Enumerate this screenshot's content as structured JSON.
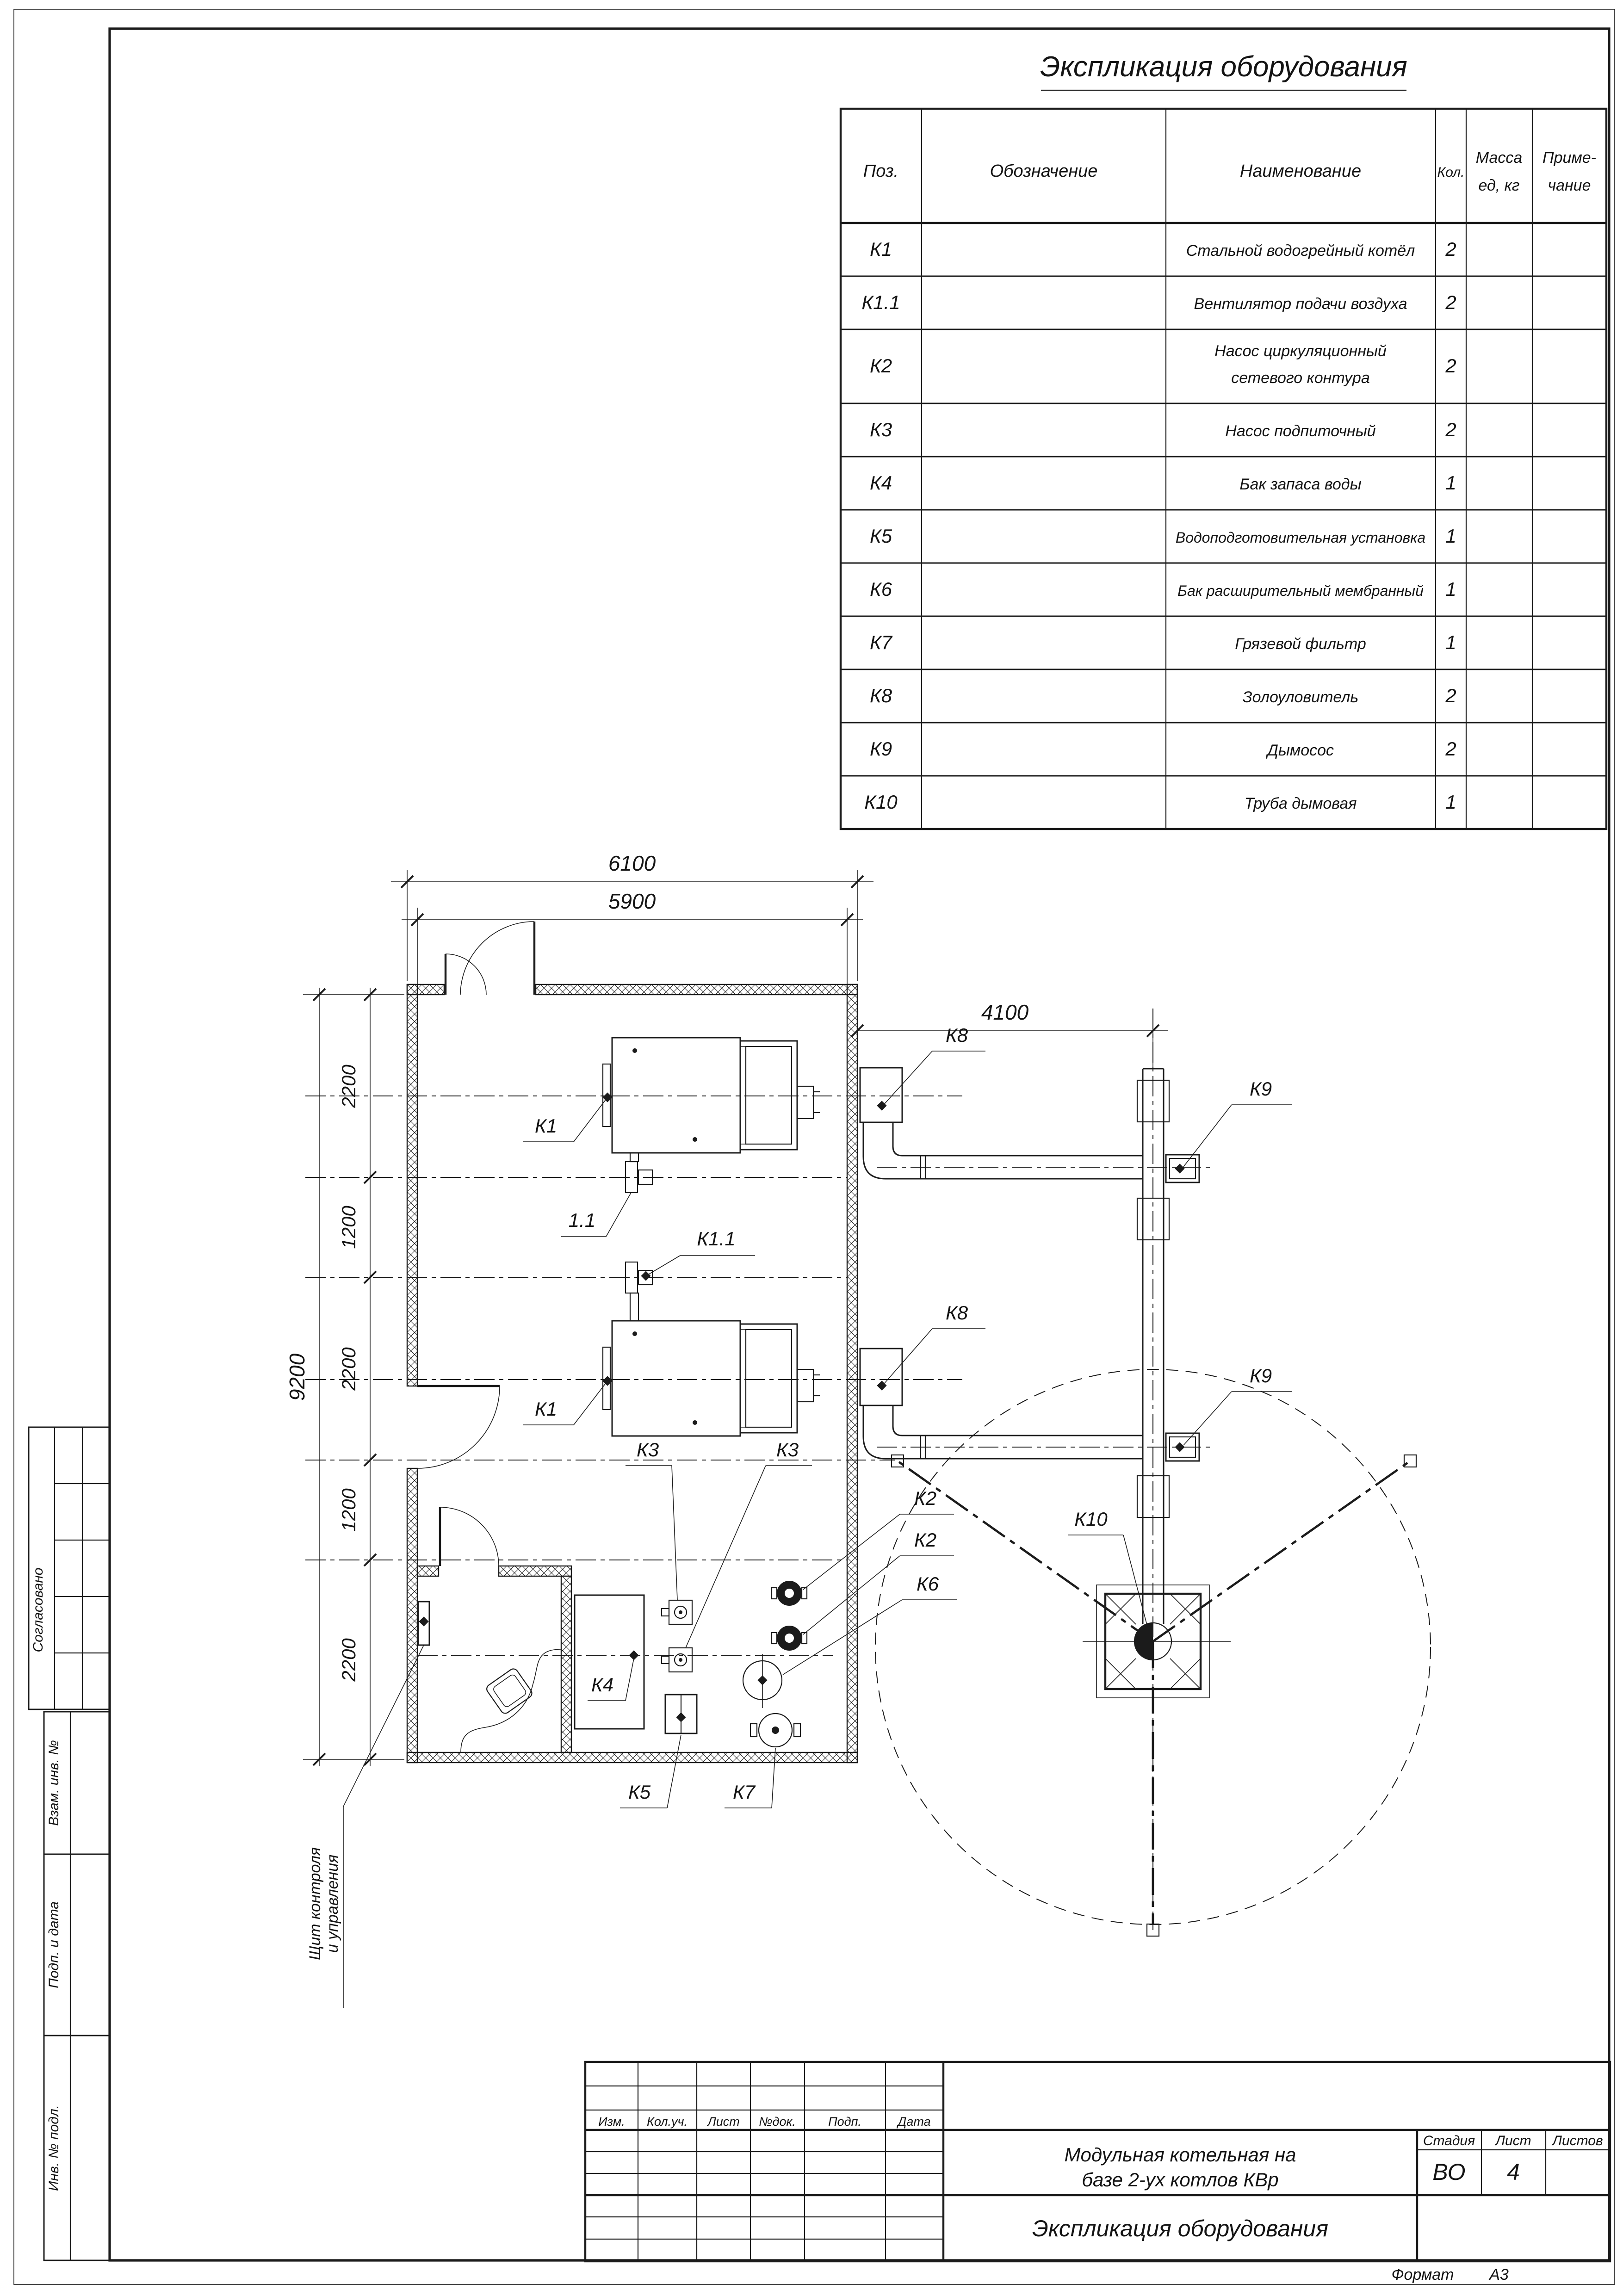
{
  "sheet": {
    "format_label": "Формат",
    "format_value": "А3"
  },
  "table": {
    "title": "Экспликация оборудования",
    "headers": {
      "pos": "Поз.",
      "designation": "Обозначение",
      "name": "Наименование",
      "qty": "Кол.",
      "mass_l1": "Масса",
      "mass_l2": "ед, кг",
      "note_l1": "Приме-",
      "note_l2": "чание"
    },
    "rows": [
      {
        "pos": "К1",
        "name": "Стальной водогрейный котёл",
        "qty": "2"
      },
      {
        "pos": "К1.1",
        "name": "Вентилятор подачи воздуха",
        "qty": "2"
      },
      {
        "pos": "К2",
        "name_l1": "Насос циркуляционный",
        "name_l2": "сетевого контура",
        "qty": "2"
      },
      {
        "pos": "К3",
        "name": "Насос подпиточный",
        "qty": "2"
      },
      {
        "pos": "К4",
        "name": "Бак запаса воды",
        "qty": "1"
      },
      {
        "pos": "К5",
        "name": "Водоподготовительная установка",
        "qty": "1"
      },
      {
        "pos": "К6",
        "name": "Бак расширительный мембранный",
        "qty": "1"
      },
      {
        "pos": "К7",
        "name": "Грязевой фильтр",
        "qty": "1"
      },
      {
        "pos": "К8",
        "name": "Золоуловитель",
        "qty": "2"
      },
      {
        "pos": "К9",
        "name": "Дымосос",
        "qty": "2"
      },
      {
        "pos": "К10",
        "name": "Труба дымовая",
        "qty": "1"
      }
    ]
  },
  "plan": {
    "dims": {
      "w6100": "6100",
      "w5900": "5900",
      "w4100": "4100",
      "h9200": "9200",
      "seg1": "2200",
      "seg2": "1200",
      "seg3": "2200",
      "seg4": "1200",
      "seg5": "2200"
    },
    "labels": {
      "k1_top": "К1",
      "fan_top": "1.1",
      "fan_mid": "К1.1",
      "k1_bottom": "К1",
      "k8_top": "К8",
      "k8_bottom": "К8",
      "k9_top": "К9",
      "k9_bottom": "К9",
      "k10": "К10",
      "k2_1": "К2",
      "k2_2": "К2",
      "k6": "К6",
      "k3_1": "К3",
      "k3_2": "К3",
      "k4": "К4",
      "k5": "К5",
      "k7": "К7"
    },
    "note": {
      "l1": "Щит контроля",
      "l2": "и управления"
    }
  },
  "titleblock": {
    "rev_headers": [
      "Изм.",
      "Кол.уч.",
      "Лист",
      "№док.",
      "Подп.",
      "Дата"
    ],
    "project_l1": "Модульная котельная на",
    "project_l2": "базе 2-ух котлов КВр",
    "doc_title": "Экспликация оборудования",
    "stage_label": "Стадия",
    "sheet_label": "Лист",
    "sheets_label": "Листов",
    "stage_value": "ВО",
    "sheet_value": "4",
    "sheets_value": ""
  },
  "margin": {
    "approved": "Согласовано",
    "replace_inv": "Взам. инв. №",
    "sign_date": "Подп. и дата",
    "inv_orig": "Инв. № подл."
  }
}
